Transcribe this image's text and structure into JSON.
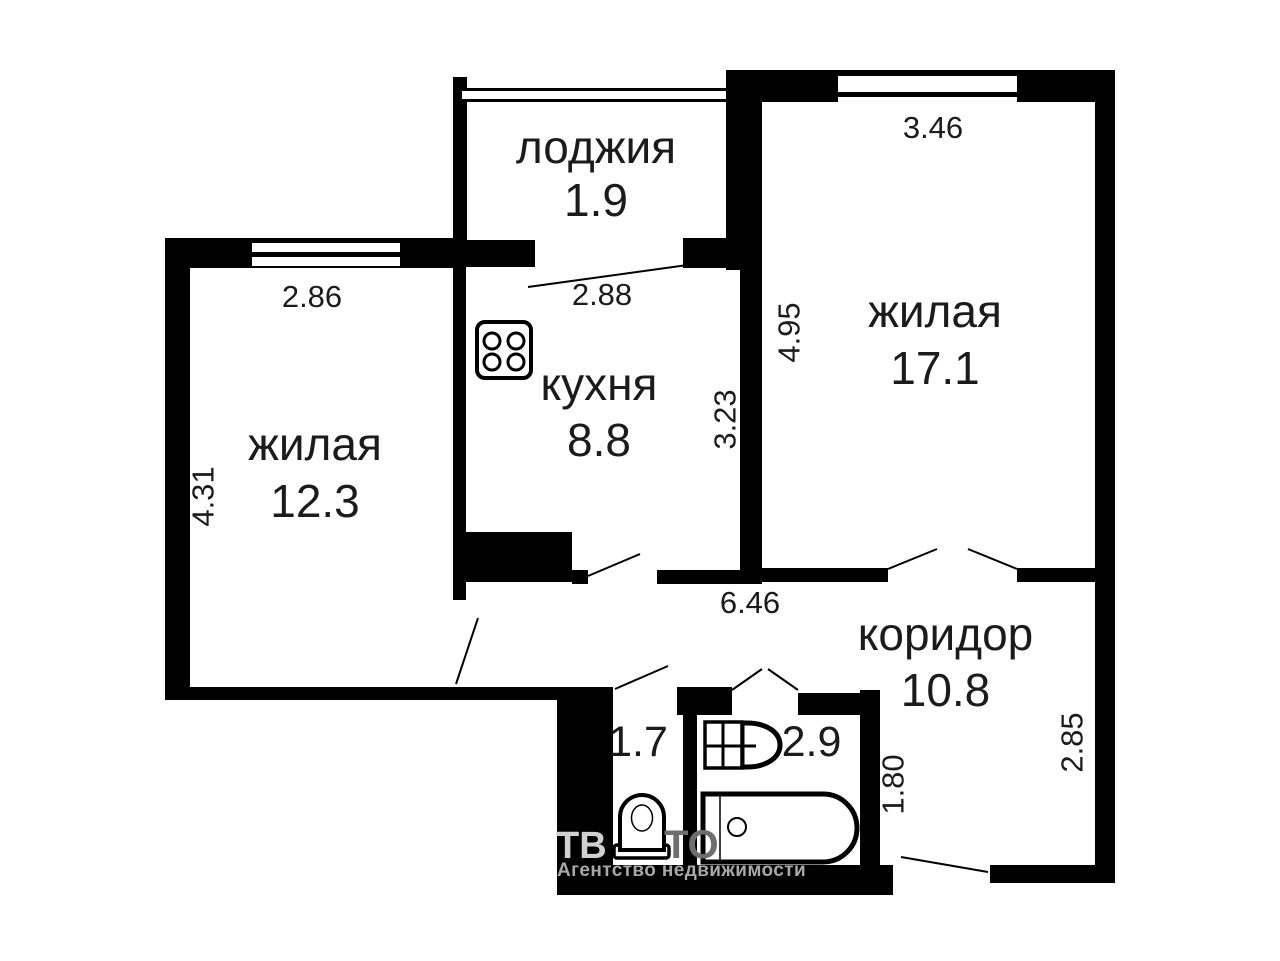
{
  "plan_title": "apartment-floor-plan",
  "rooms": [
    {
      "key": "loggia",
      "label": "лоджия",
      "area": "1.9"
    },
    {
      "key": "living-right",
      "label": "жилая",
      "area": "17.1"
    },
    {
      "key": "kitchen",
      "label": "кухня",
      "area": "8.8"
    },
    {
      "key": "living-left",
      "label": "жилая",
      "area": "12.3"
    },
    {
      "key": "corridor",
      "label": "коридор",
      "area": "10.8"
    },
    {
      "key": "wc",
      "label": "",
      "area": "1.7"
    },
    {
      "key": "bathroom",
      "label": "",
      "area": "2.9"
    }
  ],
  "dimensions": {
    "loggia_width": "2.88",
    "living_right_width": "3.46",
    "living_right_depth": "4.95",
    "living_left_width": "2.86",
    "living_left_depth": "4.31",
    "kitchen_depth": "3.23",
    "corridor_length": "6.46",
    "corridor_depth": "2.85",
    "bathroom_width": "1.80"
  },
  "fixtures": [
    "stove-icon",
    "toilet-icon",
    "sink-icon",
    "bathtub-icon"
  ],
  "watermark": {
    "brand_fragment_left": "ТВ",
    "brand_fragment_right": "ТО",
    "tagline": "Агентство недвижимости"
  },
  "colors": {
    "wall": "#000000",
    "background": "#ffffff",
    "text": "#1b1b1b",
    "watermark_light": "#d0d0d0",
    "watermark_dark": "#6e6e6e",
    "watermark_tagline": "#a8a8a8"
  }
}
